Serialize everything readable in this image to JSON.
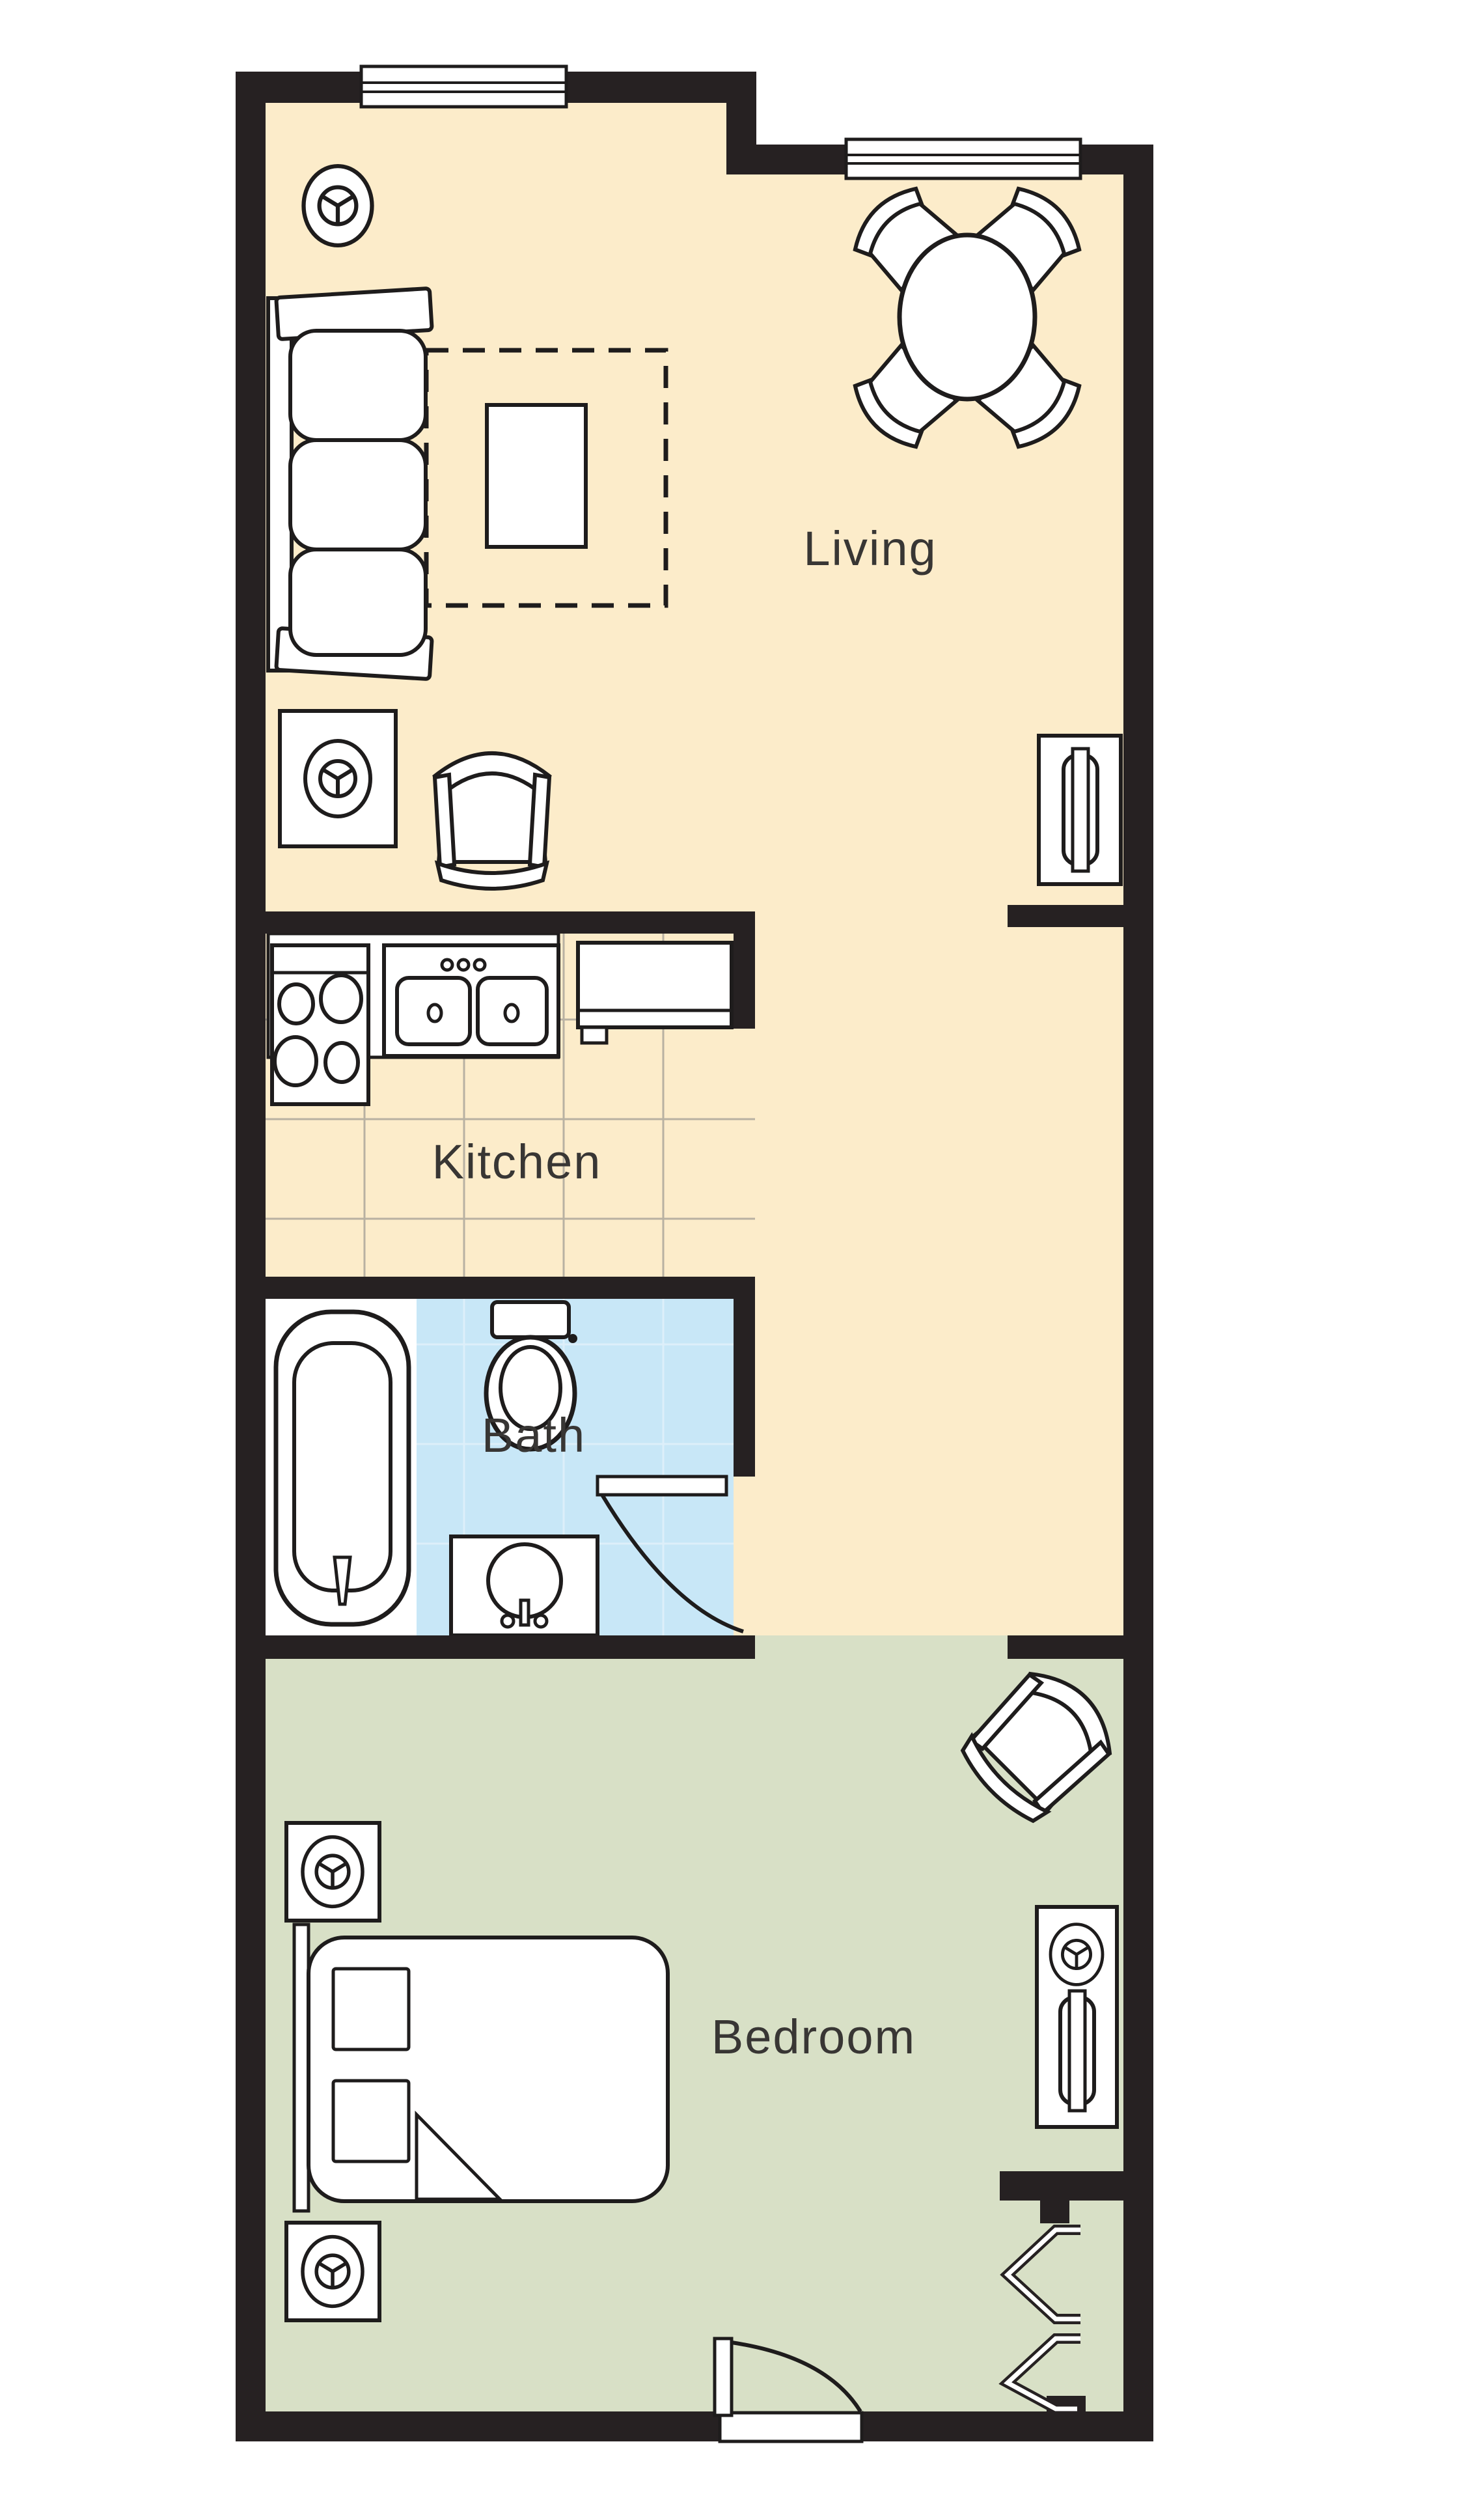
{
  "plan_title": "One-bedroom apartment floor plan",
  "rooms": {
    "living": {
      "label": "Living"
    },
    "kitchen": {
      "label": "Kitchen"
    },
    "bath": {
      "label": "Bath"
    },
    "bedroom": {
      "label": "Bedroom"
    }
  },
  "colors": {
    "wall": "#262122",
    "outline": "#1e1c1c",
    "living_floor": "#fcecca",
    "kitchen_floor": "#fcecca",
    "bath_floor": "#c8e7f7",
    "bedroom_floor": "#d8e0c6",
    "fixture_fill": "#ffffff",
    "kitchen_tile_line": "#b8b1a2",
    "bath_tile_line": "#ddeffa",
    "label_text": "#383634"
  },
  "icons": {
    "lamp": "lamp-icon",
    "tv": "tv-icon",
    "window": "window-icon",
    "door_arc": "door-swing-icon",
    "bifold": "bifold-closet-door-icon"
  },
  "furniture": {
    "living": [
      "table-lamp",
      "sofa",
      "area-rug",
      "coffee-table",
      "dining-table",
      "dining-chairs",
      "end-table-with-lamp",
      "armchair",
      "tv-console"
    ],
    "kitchen": [
      "range-stove",
      "double-sink",
      "refrigerator"
    ],
    "bath": [
      "bathtub",
      "toilet",
      "vanity-sink",
      "door-swing"
    ],
    "bedroom": [
      "corner-armchair",
      "nightstand-with-lamp",
      "bed",
      "dresser-with-tv",
      "entry-door",
      "bifold-closet-doors"
    ]
  }
}
